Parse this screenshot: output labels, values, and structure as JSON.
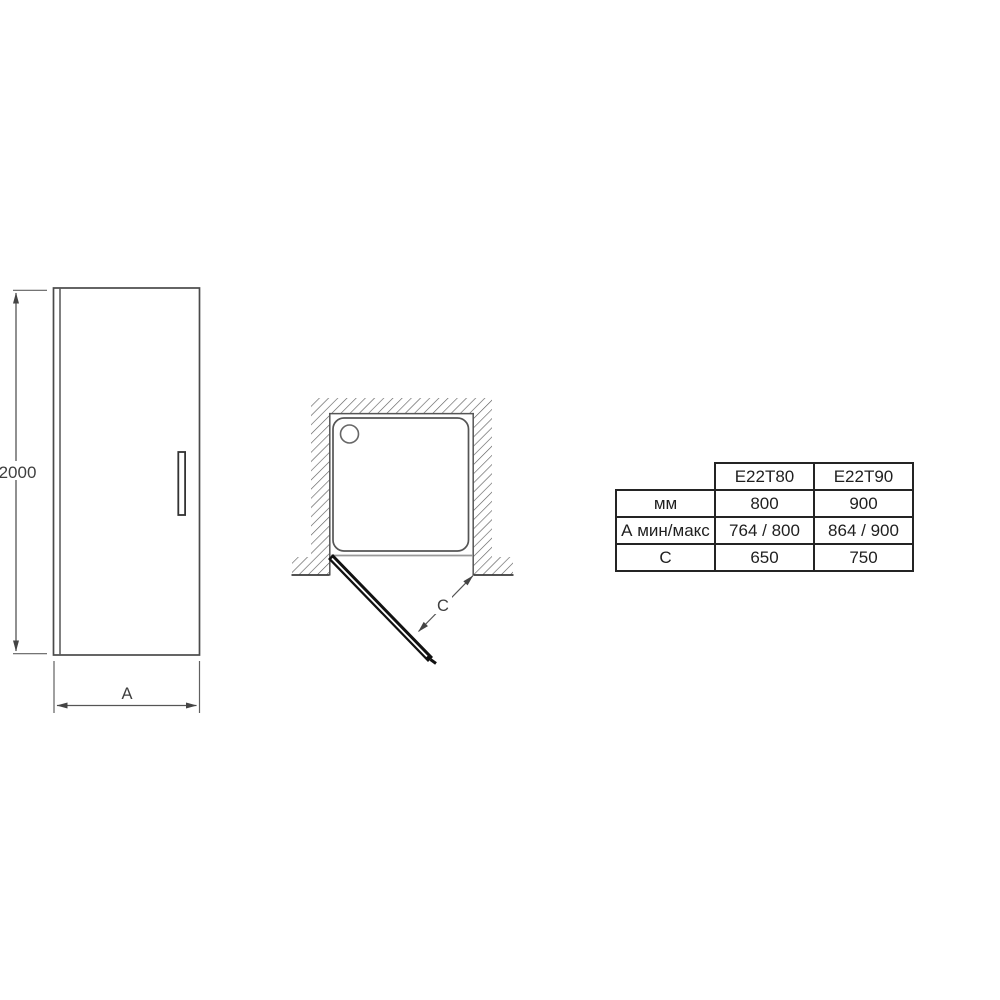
{
  "front_view": {
    "height_label": "2000",
    "width_label": "A"
  },
  "plan_view": {
    "depth_label": "C"
  },
  "spec_table": {
    "col_headers": [
      "E22T80",
      "E22T90"
    ],
    "rows": [
      {
        "label": "мм",
        "values": [
          "800",
          "900"
        ]
      },
      {
        "label": "А мин/макс",
        "values": [
          "764 / 800",
          "864 / 900"
        ]
      },
      {
        "label": "С",
        "values": [
          "650",
          "750"
        ]
      }
    ]
  },
  "icons": {
    "hatch_pattern": "wall-section-hatch",
    "arrowheads": "dimension-arrow"
  },
  "colors": {
    "line": "#4a4a4a",
    "dark_line": "#111111",
    "thin_line": "#606060",
    "light_line": "#999999",
    "table_border": "#242424",
    "background": "#ffffff"
  }
}
